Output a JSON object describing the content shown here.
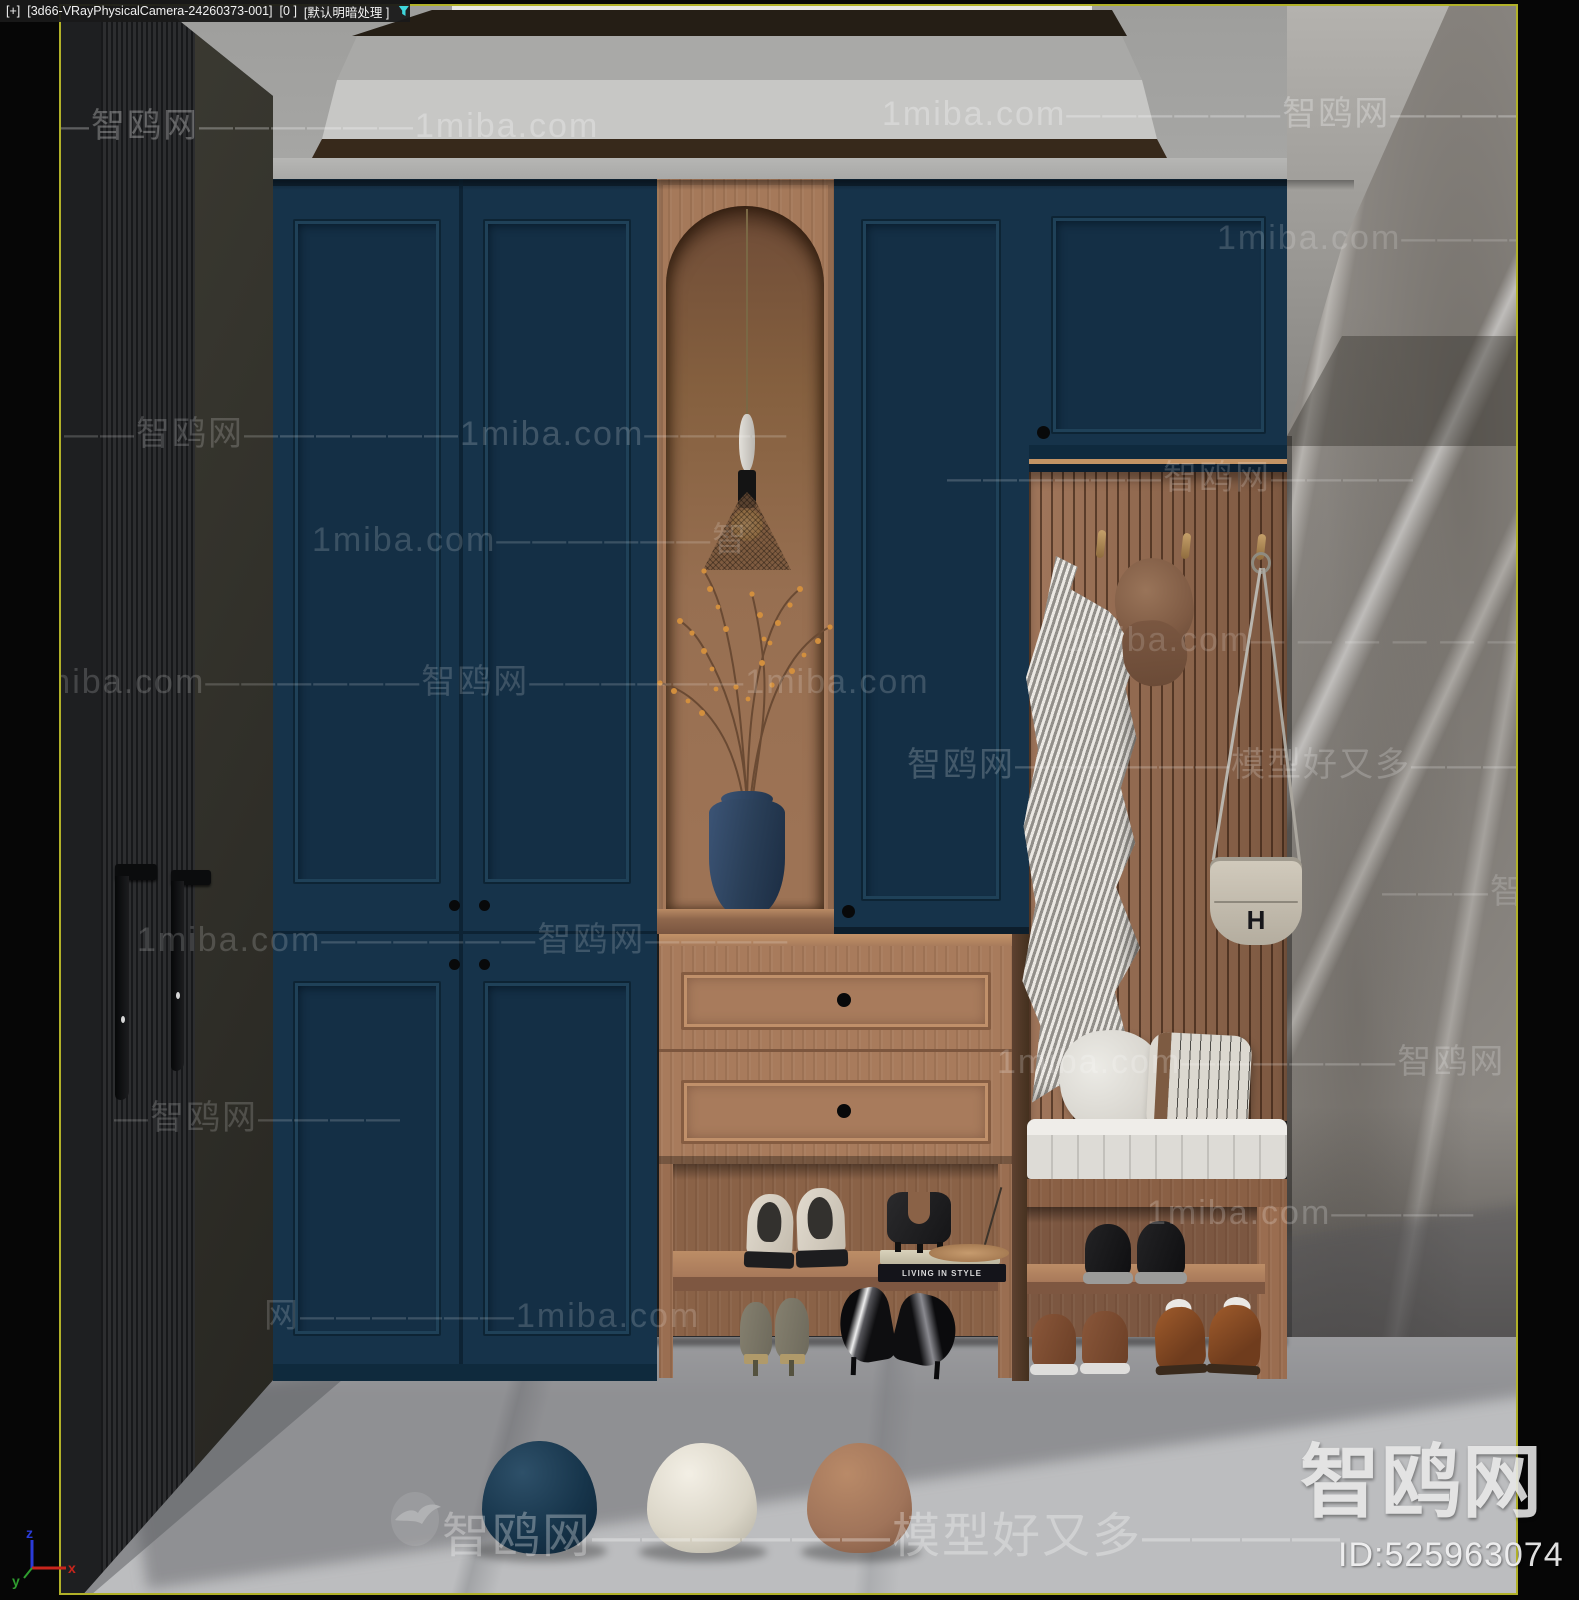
{
  "header": {
    "plus_label": "[+]",
    "camera_label": "[3d66-VRayPhysicalCamera-24260373-001]",
    "frame_label": "[0 ]",
    "shading_label": "[默认明暗处理 ]",
    "filter_icon": "funnel-icon",
    "filter_icon_color": "#3fd6dc"
  },
  "viewport": {
    "border_color": "#b1b128"
  },
  "axis_gizmo": {
    "x_label": "x",
    "y_label": "y",
    "z_label": "z",
    "x_color": "#c8251c",
    "y_color": "#2f9e2f",
    "z_color": "#2a3bd8"
  },
  "scene": {
    "book_title": "LIVING IN STYLE",
    "bag_logo": "H",
    "colors": {
      "cabinet_navy": "#16334a",
      "wood": "#a87b5c",
      "slat_wood": "#9b6e51",
      "wardrobe_dark": "#2a2b2d",
      "marble_wall": "#8d8984",
      "floor_marble": "#bcbdbf",
      "ceiling_grey": "#a3a3a1",
      "vase_navy": "#2a3f58",
      "dome_navy": "#1d3d55",
      "dome_white": "#ded9cc",
      "dome_brown": "#a0745a",
      "branch_orange": "#d28f3e"
    }
  },
  "watermarks": {
    "default_size": 34,
    "default_opacity": 0.2,
    "items": [
      {
        "text": "1miba.com——————智鸥网——————1miba.com",
        "x": 821,
        "y": 80,
        "opacity": 0.28
      },
      {
        "text": "—智鸥网——————1miba.com",
        "x": -6,
        "y": 92,
        "opacity": 0.28
      },
      {
        "text": "1miba.com——————智鸥网",
        "x": 1156,
        "y": 204,
        "opacity": 0.16
      },
      {
        "text": "——智鸥网——————1miba.com————",
        "x": 3,
        "y": 400,
        "opacity": 0.18
      },
      {
        "text": "——————智鸥网————",
        "x": 886,
        "y": 444,
        "opacity": 0.18
      },
      {
        "text": "1miba.com——————智",
        "x": 251,
        "y": 506,
        "opacity": 0.16
      },
      {
        "text": "1miba.com— — — — — —",
        "x": 1005,
        "y": 615,
        "opacity": 0.15
      },
      {
        "text": "1miba.com——————智鸥网——————1miba.com",
        "x": -40,
        "y": 648,
        "opacity": 0.17
      },
      {
        "text": "智鸥网——————模型好又多———",
        "x": 846,
        "y": 731,
        "opacity": 0.2
      },
      {
        "text": "———智鸥网",
        "x": 1321,
        "y": 858,
        "opacity": 0.17
      },
      {
        "text": "1miba.com——————智鸥网————",
        "x": 76,
        "y": 906,
        "opacity": 0.17
      },
      {
        "text": "1miba.com——————智鸥网",
        "x": 936,
        "y": 1028,
        "opacity": 0.2
      },
      {
        "text": "—智鸥网————",
        "x": 53,
        "y": 1084,
        "opacity": 0.17
      },
      {
        "text": "1miba.com————",
        "x": 1086,
        "y": 1188,
        "opacity": 0.2
      },
      {
        "text": "网——————1miba.com",
        "x": 203,
        "y": 1282,
        "opacity": 0.17
      },
      {
        "text": "智鸥网——————模型好又多————",
        "x": 381,
        "y": 1490,
        "size": 48,
        "opacity": 0.3
      }
    ]
  },
  "brand": {
    "logo_text": "智鸥网",
    "id_text": "ID:525963074"
  }
}
